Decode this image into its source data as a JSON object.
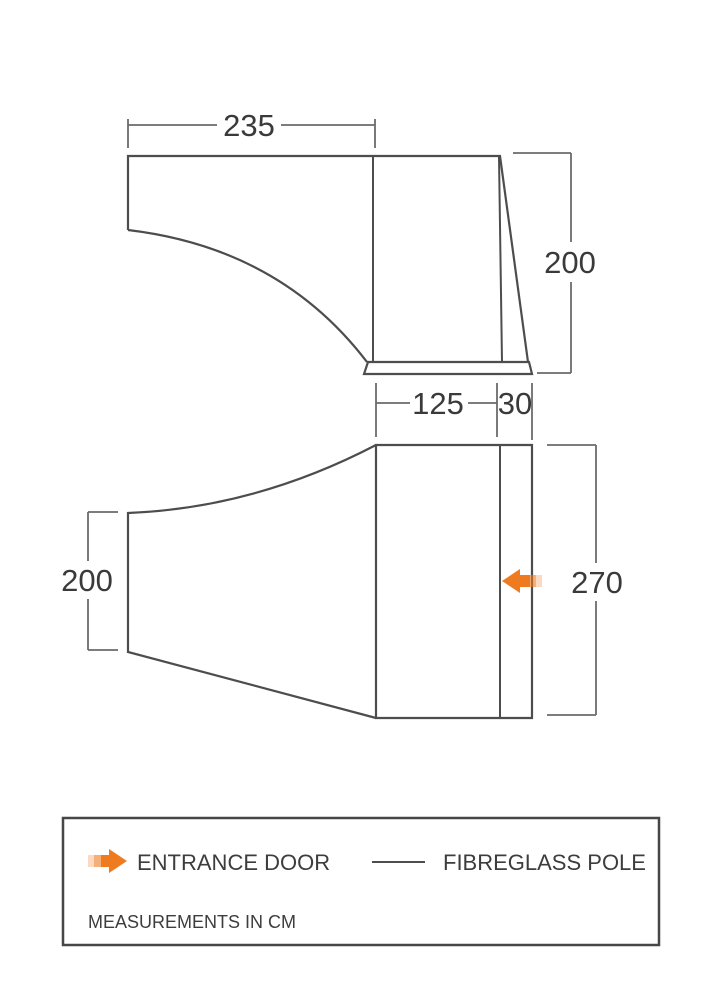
{
  "diagram_title": "tent-awning-dimension-diagram",
  "dimensions": {
    "side_view": {
      "top_width": "235",
      "right_height": "200"
    },
    "middle": {
      "main_depth": "125",
      "pole_offset": "30"
    },
    "plan_view": {
      "left_width": "200",
      "right_height": "270"
    }
  },
  "legend": {
    "entrance_door": "ENTRANCE DOOR",
    "fibreglass_pole": "FIBREGLASS POLE",
    "note": "MEASUREMENTS IN CM"
  },
  "colors": {
    "accent_orange": "#ef7b20",
    "line_gray": "#4d4d4d",
    "text_gray": "#3a3a3a"
  }
}
